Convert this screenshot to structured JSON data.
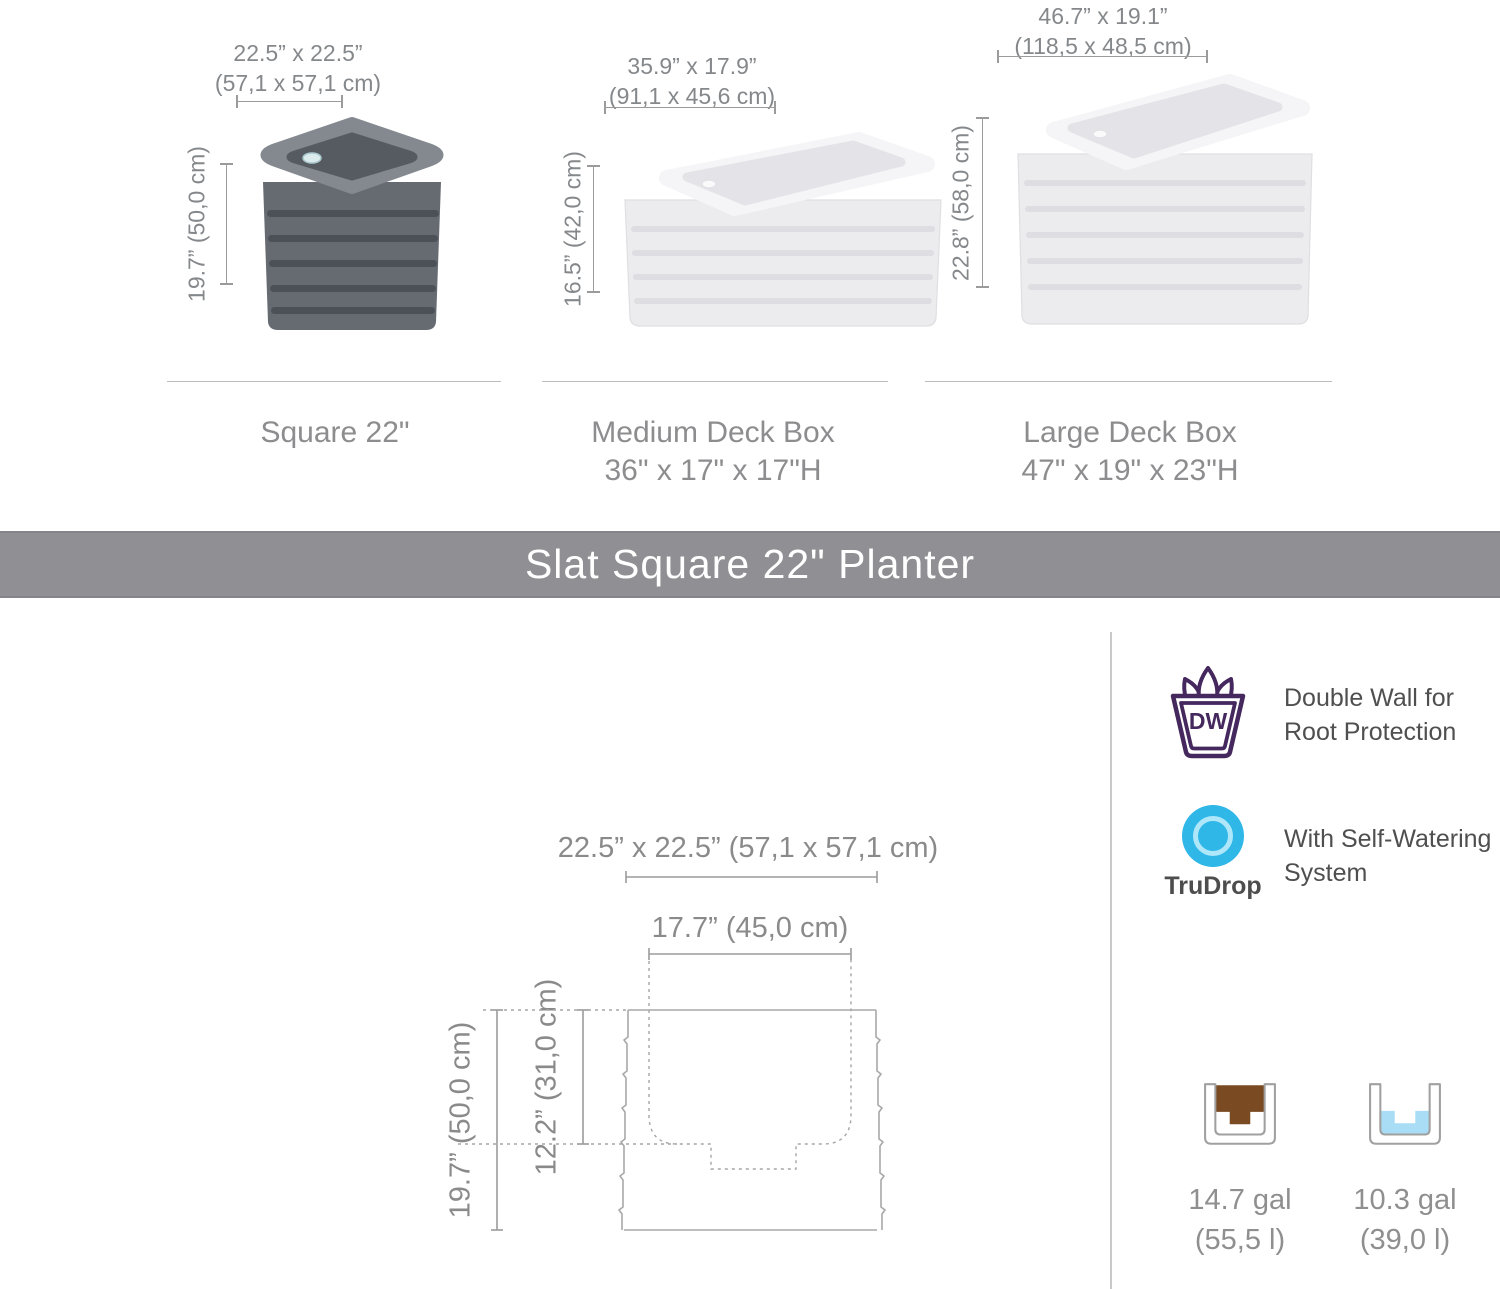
{
  "colors": {
    "banner_gray": "#8f8f94",
    "dw_purple": "#44285e",
    "trudrop_blue": "#2fb7e8",
    "soil_brown": "#7a4a22",
    "water_blue": "#a9dcf5",
    "dimension_gray": "#9b9b9b",
    "text_gray": "#8a8a8a"
  },
  "size_comparison": {
    "planters": [
      {
        "name": "Square 22\"",
        "width_label": "22.5” x 22.5”",
        "width_metric": "(57,1 x 57,1 cm)",
        "height_label": "19.7” (50,0 cm)"
      },
      {
        "name": "Medium Deck Box",
        "size_line": "36\" x 17\" x 17\"H",
        "width_label": "35.9” x 17.9”",
        "width_metric": "(91,1 x 45,6 cm)",
        "height_label": "16.5” (42,0 cm)"
      },
      {
        "name": "Large Deck Box",
        "size_line": "47\" x 19\" x 23\"H",
        "width_label": "46.7” x 19.1”",
        "width_metric": "(118,5 x 48,5 cm)",
        "height_label": "22.8” (58,0 cm)"
      }
    ]
  },
  "banner": {
    "title": "Slat Square 22\" Planter"
  },
  "tech_drawing": {
    "outer_footprint": "22.5” x 22.5” (57,1 x 57,1 cm)",
    "inner_width": "17.7” (45,0 cm)",
    "outer_height": "19.7” (50,0 cm)",
    "inner_depth": "12.2” (31,0 cm)"
  },
  "features": {
    "double_wall": {
      "badge": "DW",
      "line1": "Double Wall for",
      "line2": "Root Protection"
    },
    "self_watering": {
      "brand": "TruDrop",
      "line1": "With Self-Watering",
      "line2": "System"
    }
  },
  "capacities": {
    "soil": {
      "amount": "14.7 gal",
      "metric": "(55,5 l)"
    },
    "water": {
      "amount": "10.3 gal",
      "metric": "(39,0 l)"
    }
  }
}
